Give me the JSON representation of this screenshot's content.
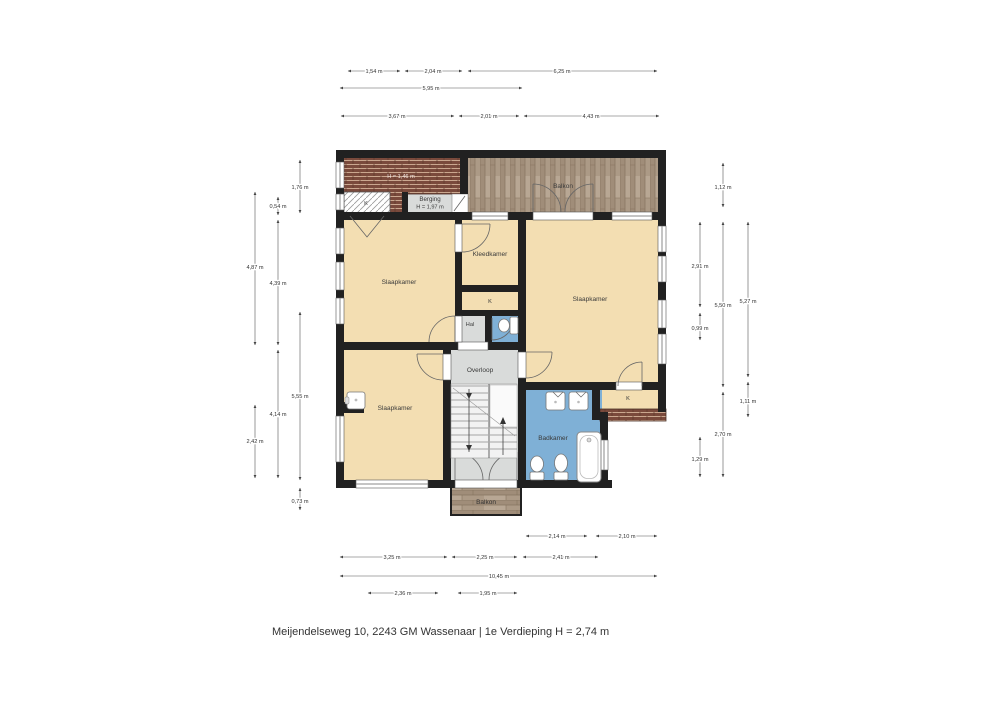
{
  "title": "Meijendelseweg 10, 2243 GM Wassenaar | 1e Verdieping H = 2,74 m",
  "rooms": {
    "roof_height": "H = 1,46 m",
    "closet_top": "K",
    "berging": "Berging",
    "berging_height": "H = 1,97 m",
    "balkon_top": "Balkon",
    "slaapkamer_left": "Slaapkamer",
    "kleedkamer": "Kleedkamer",
    "slaapkamer_right": "Slaapkamer",
    "closet_mid": "K",
    "hal": "Hal",
    "overloop": "Overloop",
    "slaapkamer_bottom": "Slaapkamer",
    "badkamer": "Badkamer",
    "closet_right": "K",
    "balkon_bottom": "Balkon"
  },
  "dimensions": {
    "top": [
      "1,54 m",
      "2,04 m",
      "6,25 m",
      "5,95 m",
      "3,67 m",
      "2,01 m",
      "4,43 m"
    ],
    "left": [
      "1,76 m",
      "0,54 m",
      "4,87 m",
      "4,39 m",
      "5,55 m",
      "4,14 m",
      "2,42 m",
      "0,73 m"
    ],
    "right": [
      "1,12 m",
      "2,91 m",
      "5,50 m",
      "5,27 m",
      "0,99 m",
      "1,11 m",
      "2,70 m",
      "1,29 m"
    ],
    "bottom": [
      "2,14 m",
      "2,10 m",
      "3,25 m",
      "2,25 m",
      "2,41 m",
      "10,45 m",
      "2,36 m",
      "1,95 m"
    ]
  },
  "colors": {
    "wall": "#212121",
    "floor": "#F3DEB2",
    "circulation": "#D9DBDA",
    "bathroom": "#7FB0D6",
    "roof": "#7A4A3C",
    "wood": "#AC9A86"
  }
}
